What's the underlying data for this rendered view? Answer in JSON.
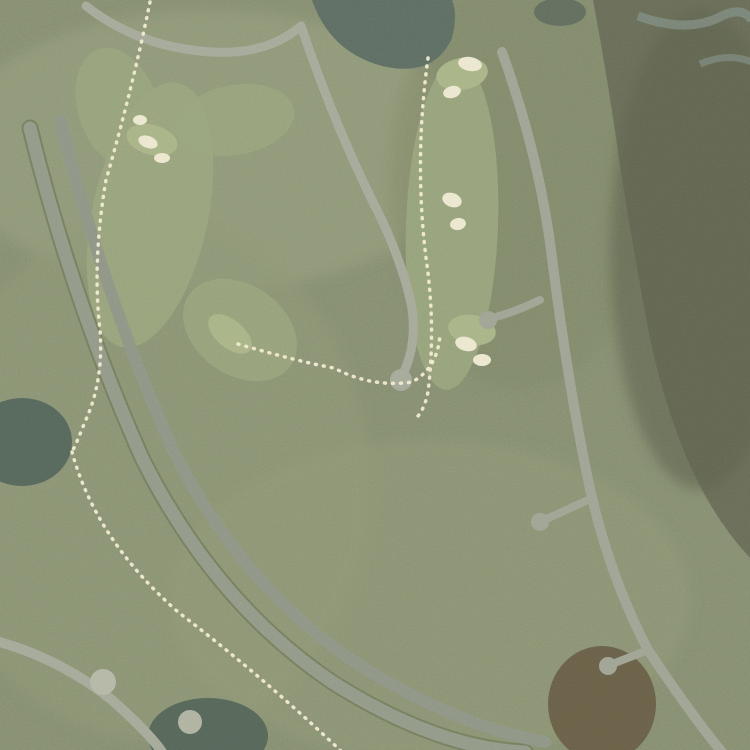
{
  "map": {
    "type": "satellite-aerial",
    "labels": [
      {
        "id": "long-boat-ct-s",
        "text": "Long Boat Ct S"
      },
      {
        "id": "s-nine-dr-upper",
        "text": "S Nine Dr"
      },
      {
        "id": "sea-island-dr",
        "text": "Sea Island Dr"
      },
      {
        "id": "s-nine-dr-lower",
        "text": "S Nine Dr"
      },
      {
        "id": "sea-island-dr-partial",
        "text": "Sea Islan"
      },
      {
        "id": "plantation-partial",
        "text": "Plant"
      }
    ],
    "highlight": {
      "stroke_color": "#1fd6c8",
      "fill_color": "rgba(0,196,178,0.5)",
      "stroke_width": 4,
      "polygons": [
        {
          "id": "north-lake-parcel",
          "points": "202,134 290,137 297,189 320,237 335,272 341,316 348,324 403,330 418,357 357,352 339,367 331,342 302,337 297,310 290,297 256,239 197,160"
        },
        {
          "id": "south-lake-parcel",
          "points": "235,363 323,377 343,371 392,397 403,405 418,437 437,453 448,497 458,513 477,523 500,541 547,567 553,607 515,598 437,615 392,597 373,527 355,483 323,460 244,430 229,385"
        }
      ]
    },
    "marker": {
      "id": "top-edge-marker",
      "points": "230,0 254,0 242,13",
      "color": "#1fd6c8",
      "inner_color": "#eef8f6"
    }
  }
}
